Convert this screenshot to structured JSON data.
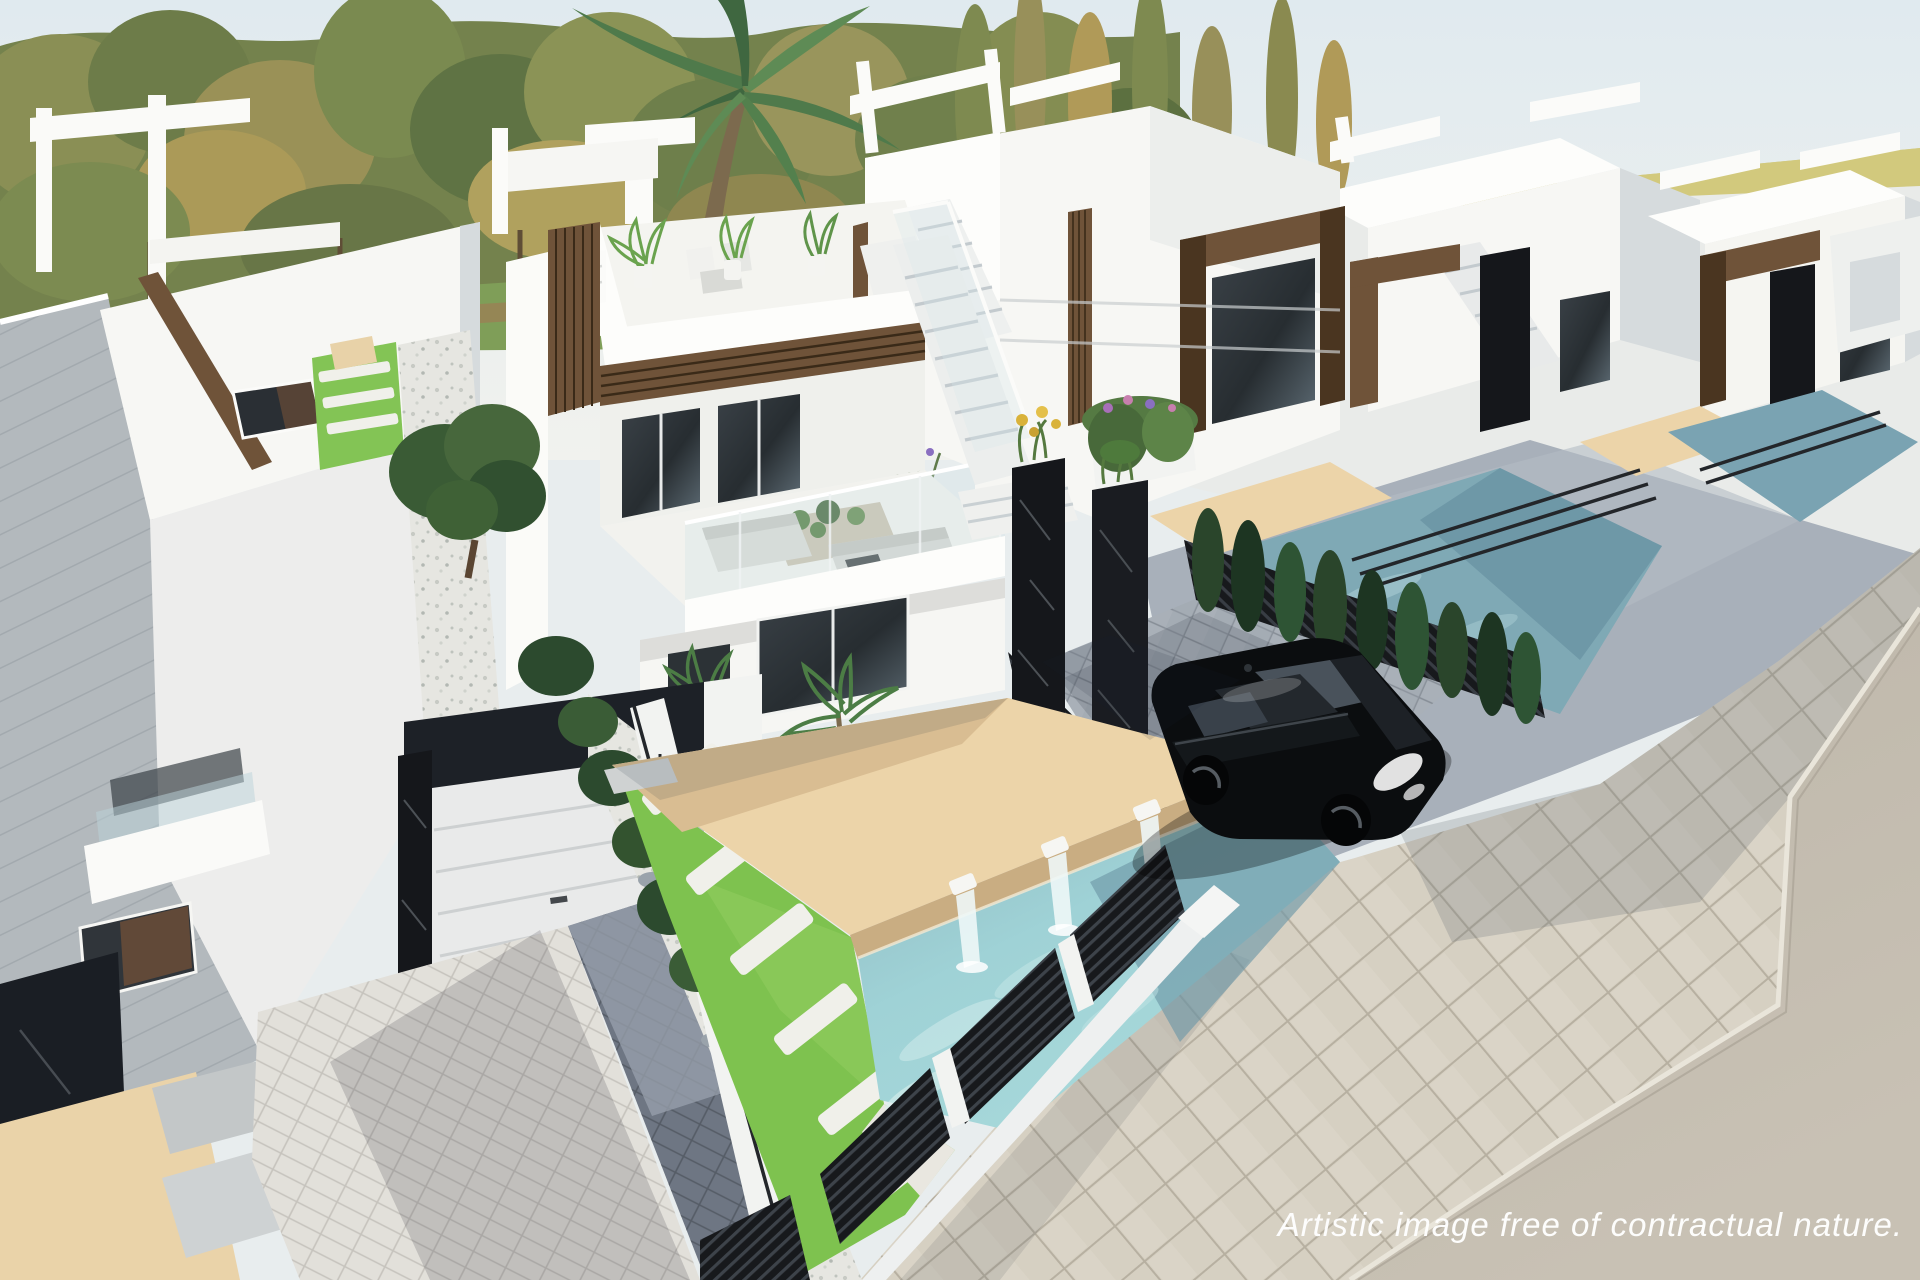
{
  "caption": {
    "text": "Artistic image free of contractual nature."
  },
  "colors": {
    "sky_top": "#e0eaef",
    "sky_bottom": "#f1f2ee",
    "field": "#c6c075",
    "field_light": "#d5cc80",
    "lawn": "#7f9e58",
    "lawn_path": "#9b8055",
    "tree_olive": "#74824d",
    "tree_dark": "#5f7344",
    "tree_light": "#8b9356",
    "tree_autumn": "#ab9a58",
    "palm": "#4f7a4b",
    "palm_dark": "#3f6740",
    "villa_white": "#f7f7f4",
    "villa_sun": "#fdfdfb",
    "villa_top": "#efefec",
    "villa_shade": "#d6dbdd",
    "villa_deep": "#bfc6ca",
    "wood": "#6f5339",
    "wood_dark": "#4a3520",
    "marble": "#15171b",
    "marble_streak": "#838b91",
    "glass": "#31383d",
    "glass_light": "#5d6b74",
    "pool": "#9fd2d6",
    "pool_deep": "#6f98a8",
    "pool_light": "#cdeaea",
    "pool_far": "#7fa9b5",
    "deck": "#ecd4a9",
    "deck_shade": "#d9bd92",
    "deck_face": "#c9ad82",
    "grass": "#7ec24f",
    "step_white": "#f0f0ea",
    "gravel": "#e6e6e1",
    "rock": "#9aa3ab",
    "paver_light": "#e2e0da",
    "paver_dark": "#6e7683",
    "paver_car": "#a9b0b8",
    "sidewalk": "#d6d0c2",
    "road": "#c8c1b4",
    "curb": "#e9e5da",
    "fence": "#17191c",
    "hedge": "#2a452b",
    "hedge_dark": "#1d3522",
    "car_body": "#0b0d0f",
    "caption_color": "#ffffff"
  }
}
